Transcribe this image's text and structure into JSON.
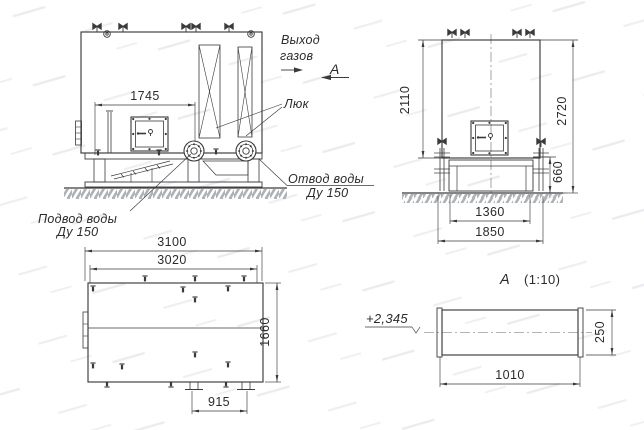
{
  "meta": {
    "background": "#ffffff",
    "line_color": "#3a3a3c",
    "text_color": "#2b2b2d",
    "ground_hatch_color": "#aeb2b6"
  },
  "front_view": {
    "dim_top": "1745",
    "gas_label_1": "Выход",
    "gas_label_2": "газов",
    "section_mark": "А",
    "hatch_label": "Люк",
    "outlet_label_1": "Отвод воды",
    "outlet_label_2": "Ду 150",
    "supply_label_1": "Подвод воды",
    "supply_label_2": "Ду 150"
  },
  "side_view": {
    "dim_box_height": "2110",
    "dim_total_height": "2720",
    "dim_base_height": "660",
    "dim_base_inner": "1360",
    "dim_base_outer": "1850"
  },
  "plan_view": {
    "dim_outer_length": "3100",
    "dim_inner_length": "3020",
    "dim_width": "1660",
    "dim_support_spacing": "915"
  },
  "section_view": {
    "title_letter": "А",
    "title_scale": "(1:10)",
    "level_mark": "+2,345",
    "dim_width": "1010",
    "dim_height": "250"
  }
}
